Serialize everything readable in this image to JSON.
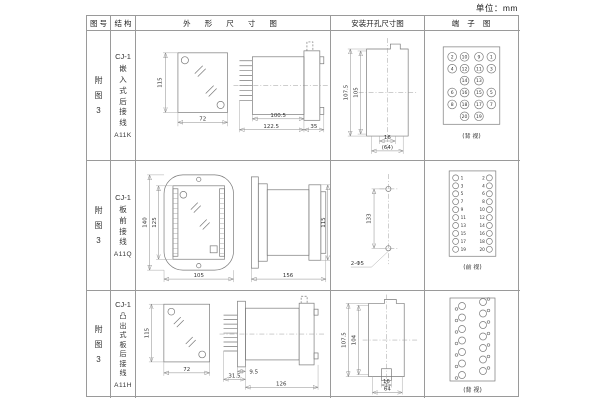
{
  "unit_label": "单位：mm",
  "table": {
    "headers": {
      "fig": "图 号",
      "structure": "结 构",
      "outline": "外 形 尺 寸 图",
      "install": "安装开孔尺寸图",
      "terminal": "端 子 图"
    },
    "rows": [
      {
        "fig": "附图3",
        "model": "CJ-1",
        "desc": "嵌入式后接线",
        "code": "A11K",
        "outline": {
          "front_h": "115",
          "front_w": "72",
          "d1": "100.5",
          "d2": "122.5",
          "d3": "35"
        },
        "install": {
          "v1": "107.5",
          "v2": "105",
          "h1": "16",
          "h2": "(64)"
        },
        "terminal": {
          "view_label": "(背 视)",
          "grid": [
            [
              "2",
              "10",
              "9",
              "1"
            ],
            [
              "4",
              "12",
              "11",
              "3"
            ],
            [
              "",
              "14",
              "13",
              ""
            ],
            [
              "6",
              "16",
              "15",
              "5"
            ],
            [
              "8",
              "18",
              "17",
              "7"
            ],
            [
              "",
              "20",
              "19",
              ""
            ]
          ]
        }
      },
      {
        "fig": "附图3",
        "model": "CJ-1",
        "desc": "板前接线",
        "code": "A11Q",
        "outline": {
          "front_h_outer": "140",
          "front_h_inner": "125",
          "front_w": "105",
          "side_w": "156",
          "side_h": "115"
        },
        "install": {
          "v1": "133",
          "hole_label": "2-Φ5"
        },
        "terminal": {
          "view_label": "(前 视)",
          "left_numbers": [
            "1",
            "3",
            "5",
            "7",
            "9",
            "11",
            "13",
            "15",
            "17",
            "19"
          ],
          "right_numbers": [
            "2",
            "4",
            "6",
            "8",
            "10",
            "12",
            "14",
            "16",
            "18",
            "20"
          ]
        }
      },
      {
        "fig": "附图3",
        "model": "CJ-1",
        "desc": "凸出式板后接线",
        "code": "A11H",
        "outline": {
          "front_h": "115",
          "front_w": "72",
          "d1": "31.5",
          "d2": "9.5",
          "d3": "126"
        },
        "install": {
          "v1": "107.5",
          "v2": "104",
          "h1": "16",
          "h2": "64"
        },
        "terminal": {
          "view_label": "(背 视)",
          "left_count": 7,
          "right_count": 7
        }
      }
    ]
  }
}
